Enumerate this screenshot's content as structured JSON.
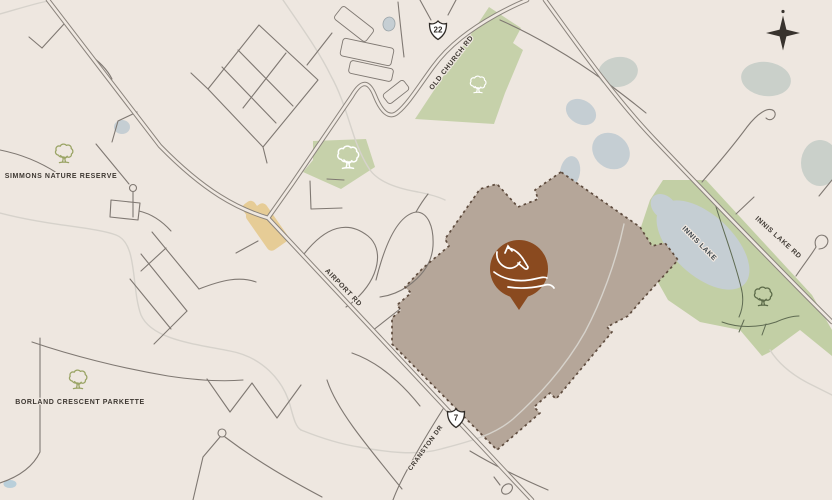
{
  "title": "Site location map",
  "colors": {
    "background": "#eee7e0",
    "road_casing": "#8b847d",
    "road_inner": "#efe8e1",
    "road_minor": "#7f7872",
    "creek": "#d6d2cb",
    "green": "#c6d1aa",
    "water": "#c5ced3",
    "gray_pond": "#cad0ca",
    "property_fill": "#b5a699",
    "property_border": "#5e4b3d",
    "pin": "#8a4a1f",
    "label_text": "#3e3832",
    "lake_label_text": "#3f474c",
    "village": "#e6cc96",
    "compass": "#38332e",
    "tree_olive": "#9aa465",
    "tree_white": "#ffffff",
    "tree_dark": "#5c6b49",
    "trail": "#5f6b52",
    "shield_stroke": "#2e2a26"
  },
  "map": {
    "width": 832,
    "height": 500,
    "labels": [
      {
        "name": "label-simmons-nature-reserve",
        "text": "SIMMONS NATURE RESERVE",
        "x": 61,
        "y": 178,
        "rot": 0,
        "size": 7,
        "color": "#3e3832"
      },
      {
        "name": "label-borland-crescent-parkette",
        "text": "BORLAND CRESCENT PARKETTE",
        "x": 80,
        "y": 404,
        "rot": 0,
        "size": 7,
        "color": "#3e3832"
      },
      {
        "name": "label-old-church-rd",
        "text": "OLD CHURCH RD",
        "x": 453,
        "y": 64,
        "rot": -52,
        "size": 7,
        "color": "#3e3832"
      },
      {
        "name": "label-airport-rd",
        "text": "AIRPORT RD",
        "x": 342,
        "y": 289,
        "rot": 46,
        "size": 7,
        "color": "#3e3832"
      },
      {
        "name": "label-innis-lake-rd",
        "text": "INNIS LAKE RD",
        "x": 777,
        "y": 239,
        "rot": 42,
        "size": 7,
        "color": "#3e3832"
      },
      {
        "name": "label-innis-lake",
        "text": "INNIS LAKE",
        "x": 698,
        "y": 245,
        "rot": 45,
        "size": 7,
        "color": "#3f474c"
      },
      {
        "name": "label-cranston-dr",
        "text": "CRANSTON DR",
        "x": 427,
        "y": 449,
        "rot": -54,
        "size": 6.5,
        "color": "#3e3832"
      }
    ],
    "shields": [
      {
        "name": "highway-22-shield",
        "number": "22",
        "x": 438,
        "y": 30
      },
      {
        "name": "highway-7-shield",
        "number": "7",
        "x": 456,
        "y": 418
      }
    ],
    "shield_path": "M 0,-9 C 2,-6.5 5.5,-5.5 8.5,-6.5 C 8.5,-1 7.5,4.5 0,9.5 C -7.5,4.5 -8.5,-1 -8.5,-6.5 C -5.5,-5.5 -2,-6.5 0,-9 Z",
    "compass": {
      "name": "north-compass",
      "x": 783,
      "y": 33,
      "star": "M 0,-17.5 L 3.4,-3.4 L 17,0 L 3.4,3.4 L 0,17.5 L -3.4,3.4 L -17,0 L -3.4,-3.4 Z",
      "dot_dy": -21.5,
      "dot_r": 1.6
    },
    "greens": [
      {
        "name": "green-old-church-woods",
        "fill": "#c6d1aa",
        "points": [
          [
            489,
            7
          ],
          [
            415,
            119
          ],
          [
            494,
            124
          ],
          [
            505,
            93
          ],
          [
            523,
            50
          ],
          [
            513,
            43
          ],
          [
            521,
            28
          ]
        ]
      },
      {
        "name": "green-airport-parkette",
        "fill": "#c6d1aa",
        "points": [
          [
            313,
            141
          ],
          [
            366,
            139
          ],
          [
            375,
            167
          ],
          [
            341,
            189
          ],
          [
            303,
            172
          ],
          [
            313,
            160
          ]
        ]
      },
      {
        "name": "green-innis-lake-conservation",
        "fill": "#c2cfa5",
        "points": [
          [
            663,
            180
          ],
          [
            706,
            180
          ],
          [
            812,
            295
          ],
          [
            832,
            330
          ],
          [
            832,
            356
          ],
          [
            800,
            330
          ],
          [
            770,
            352
          ],
          [
            762,
            356
          ],
          [
            740,
            330
          ],
          [
            700,
            322
          ],
          [
            668,
            300
          ],
          [
            650,
            268
          ],
          [
            640,
            230
          ],
          [
            650,
            200
          ]
        ]
      }
    ],
    "water": [
      {
        "name": "innis-lake",
        "fill": "#c5ced3",
        "x": 703,
        "y": 245,
        "rx": 57,
        "ry": 30,
        "rot": 43
      },
      {
        "name": "innis-lake-north-lobe",
        "fill": "#c5ced3",
        "x": 664,
        "y": 207,
        "rx": 15,
        "ry": 11,
        "rot": 43
      },
      {
        "name": "pond-small-west",
        "fill": "#c5ced3",
        "x": 122,
        "y": 127,
        "rx": 8,
        "ry": 7,
        "rot": 0
      },
      {
        "name": "pond-outlined",
        "fill": "#c5ced3",
        "stroke": "#9aa4a8",
        "x": 389,
        "y": 24,
        "rx": 6,
        "ry": 7,
        "rot": 10
      },
      {
        "name": "pond-cluster-a",
        "fill": "#c5ced3",
        "x": 581,
        "y": 112,
        "rx": 16,
        "ry": 12,
        "rot": 30
      },
      {
        "name": "pond-cluster-b",
        "fill": "#c5ced3",
        "x": 611,
        "y": 151,
        "rx": 20,
        "ry": 17,
        "rot": 40
      },
      {
        "name": "pond-cluster-c",
        "fill": "#c5ced3",
        "x": 570,
        "y": 172,
        "rx": 10,
        "ry": 16,
        "rot": 10
      },
      {
        "name": "pond-gray-north",
        "fill": "#cad0ca",
        "x": 618,
        "y": 72,
        "rx": 20,
        "ry": 15,
        "rot": -10
      },
      {
        "name": "pond-gray-northeast",
        "fill": "#cad0ca",
        "x": 766,
        "y": 79,
        "rx": 25,
        "ry": 17,
        "rot": 8
      },
      {
        "name": "pond-gray-east-edge",
        "fill": "#cad0ca",
        "x": 820,
        "y": 163,
        "rx": 19,
        "ry": 23,
        "rot": 0
      },
      {
        "name": "pond-bottom-left",
        "fill": "#b9cfda",
        "x": 10,
        "y": 484,
        "rx": 6.5,
        "ry": 4,
        "rot": 0
      }
    ],
    "village_blobs": [
      {
        "name": "village-area-main",
        "x": 267,
        "y": 227,
        "w": 46,
        "h": 24,
        "rot": 55
      },
      {
        "name": "village-area-lobe",
        "x": 252,
        "y": 211,
        "w": 20,
        "h": 14,
        "rot": 55
      }
    ],
    "buildings": [
      {
        "name": "building-outline-1",
        "x": 354,
        "y": 24,
        "w": 40,
        "h": 16,
        "rot": 38
      },
      {
        "name": "building-outline-2",
        "x": 367,
        "y": 52,
        "w": 52,
        "h": 18,
        "rot": 12
      },
      {
        "name": "building-outline-3",
        "x": 371,
        "y": 71,
        "w": 44,
        "h": 13,
        "rot": 12
      },
      {
        "name": "building-outline-4",
        "x": 396,
        "y": 92,
        "w": 26,
        "h": 12,
        "rot": -38
      }
    ],
    "property": {
      "name": "property-parcel",
      "fill": "#b5a699",
      "border": "#5e4b3d",
      "points": [
        [
          561,
          172
        ],
        [
          535,
          190
        ],
        [
          538,
          199
        ],
        [
          518,
          207
        ],
        [
          497,
          184
        ],
        [
          480,
          189
        ],
        [
          445,
          239
        ],
        [
          449,
          246
        ],
        [
          423,
          268
        ],
        [
          405,
          287
        ],
        [
          411,
          293
        ],
        [
          397,
          305
        ],
        [
          401,
          310
        ],
        [
          392,
          318
        ],
        [
          392,
          344
        ],
        [
          497,
          450
        ],
        [
          540,
          413
        ],
        [
          534,
          407
        ],
        [
          550,
          393
        ],
        [
          556,
          399
        ],
        [
          612,
          332
        ],
        [
          607,
          327
        ],
        [
          628,
          316
        ],
        [
          640,
          302
        ],
        [
          678,
          260
        ],
        [
          665,
          243
        ],
        [
          652,
          246
        ],
        [
          640,
          227
        ]
      ]
    },
    "creeks": [
      {
        "name": "creek-top-left",
        "d": "M 0,14 C 18,9 33,4 48,1"
      },
      {
        "name": "creek-west",
        "d": "M 0,213 C 50,226 95,227 116,235 C 138,243 131,288 141,315 C 152,340 196,344 230,351 C 262,357 283,380 290,405 C 294,420 296,427 301,430"
      },
      {
        "name": "creek-old-church",
        "d": "M 283,0 C 300,25 319,51 331,76 C 341,94 346,112 352,130 C 357,146 362,158 370,170 C 378,181 394,188 418,192 C 428,194 437,196 445,200"
      },
      {
        "name": "creek-property",
        "d": "M 624,224 C 616,262 601,302 585,332 C 567,364 541,394 513,419 C 493,436 467,442 441,449 C 416,456 386,452 359,447 C 339,444 316,436 301,430"
      },
      {
        "name": "creek-lake-outlet",
        "d": "M 770,350 C 780,366 797,378 814,386 C 820,389 826,392 832,395"
      }
    ],
    "roads_minor": [
      {
        "name": "street",
        "d": "M 64,24 L 42,48"
      },
      {
        "name": "street",
        "d": "M 42,48 L 29,37"
      },
      {
        "name": "street",
        "d": "M 87,53 C 99,61 107,69 112,79"
      },
      {
        "name": "street-subdivision-loop",
        "d": "M 259,25 L 318,80 L 263,147 L 208,89 Z"
      },
      {
        "name": "street",
        "d": "M 238,50 L 293,106"
      },
      {
        "name": "street",
        "d": "M 222,67 L 276,123"
      },
      {
        "name": "street",
        "d": "M 286,53 L 243,108"
      },
      {
        "name": "street",
        "d": "M 208,89 L 191,73"
      },
      {
        "name": "street",
        "d": "M 263,147 L 267,163"
      },
      {
        "name": "street",
        "d": "M 420,0 L 431,20"
      },
      {
        "name": "street",
        "d": "M 456,0 L 448,15"
      },
      {
        "name": "street",
        "d": "M 332,33 L 307,65"
      },
      {
        "name": "street",
        "d": "M 398,2 C 400,22 402,40 404,57"
      },
      {
        "name": "street",
        "d": "M 112,142 L 118,121 L 137,112"
      },
      {
        "name": "street",
        "d": "M 133,192 L 133,217"
      },
      {
        "name": "street-block-loop",
        "d": "M 111,200 L 140,203 L 138,220 L 110,217 Z"
      },
      {
        "name": "street",
        "d": "M 139,211 C 152,214 162,221 171,231"
      },
      {
        "name": "street",
        "d": "M 96,144 L 129,184"
      },
      {
        "name": "street",
        "d": "M 0,150 C 20,154 40,162 57,173"
      },
      {
        "name": "street",
        "d": "M 152,232 L 199,289"
      },
      {
        "name": "street",
        "d": "M 141,254 L 187,311"
      },
      {
        "name": "street",
        "d": "M 130,279 L 171,329"
      },
      {
        "name": "street",
        "d": "M 166,248 L 141,271"
      },
      {
        "name": "street",
        "d": "M 187,311 L 154,344"
      },
      {
        "name": "street",
        "d": "M 199,289 C 222,280 240,276 256,282"
      },
      {
        "name": "street",
        "d": "M 236,253 L 258,241"
      },
      {
        "name": "street",
        "d": "M 310,181 L 311,209 L 342,208"
      },
      {
        "name": "street",
        "d": "M 327,179 L 344,180"
      },
      {
        "name": "street-arch",
        "d": "M 304,254 C 326,226 348,220 368,236 C 384,249 380,277 355,300 C 352,303 349,305 346,307"
      },
      {
        "name": "street-arch",
        "d": "M 376,280 C 386,240 399,215 416,212 C 428,212 434,227 433,246 C 432,263 422,276 408,286 C 398,293 388,296 380,297"
      },
      {
        "name": "street",
        "d": "M 416,212 C 420,205 424,199 428,194"
      },
      {
        "name": "street",
        "d": "M 372,331 L 400,309"
      },
      {
        "name": "street",
        "d": "M 352,353 C 378,362 400,381 420,406"
      },
      {
        "name": "street-cranston-dr",
        "d": "M 443,409 C 431,428 420,446 411,463 C 403,477 397,489 393,500"
      },
      {
        "name": "street",
        "d": "M 40,338 L 40,452 C 33,467 18,477 0,483"
      },
      {
        "name": "street",
        "d": "M 32,342 C 70,355 120,368 168,376 C 195,380 220,382 243,380"
      },
      {
        "name": "street",
        "d": "M 207,379 L 230,412 L 252,383 L 277,418 L 301,385"
      },
      {
        "name": "street",
        "d": "M 327,380 C 336,408 362,440 402,489"
      },
      {
        "name": "street",
        "d": "M 220,437 L 203,457 L 193,500"
      },
      {
        "name": "street",
        "d": "M 225,437 C 258,462 290,480 322,497"
      },
      {
        "name": "street",
        "d": "M 500,485 L 494,477"
      },
      {
        "name": "street",
        "d": "M 470,451 C 495,466 520,478 548,490"
      },
      {
        "name": "street",
        "d": "M 500,20 C 532,34 572,57 606,82 C 622,94 634,103 646,113"
      },
      {
        "name": "street",
        "d": "M 736,214 L 754,197"
      },
      {
        "name": "street-hook-north",
        "d": "M 702,182 C 712,170 727,154 747,127 C 757,114 768,106 774,111 C 778,116 771,123 766,118"
      },
      {
        "name": "street-hook-east",
        "d": "M 796,276 C 804,264 812,254 816,247 C 813,239 819,233 825,236 C 831,240 827,249 819,249"
      },
      {
        "name": "street",
        "d": "M 832,180 L 819,196"
      }
    ],
    "trails": [
      {
        "name": "park-trail",
        "d": "M 714,200 C 722,228 734,258 741,287 C 744,298 743,308 739,317"
      },
      {
        "name": "park-trail",
        "d": "M 722,322 C 738,328 758,328 776,322 C 785,318 792,316 799,316"
      },
      {
        "name": "park-trail",
        "d": "M 744,320 L 739,332"
      },
      {
        "name": "park-trail",
        "d": "M 766,324 L 762,335"
      }
    ],
    "roads_major": [
      {
        "name": "road-airport-rd-hwy7",
        "d": "M 48,0 L 160,146 C 205,192 238,209 268,218 L 532,500"
      },
      {
        "name": "road-old-church-rd",
        "d": "M 268,218 L 292,184 L 352,96 C 362,79 369,81 375,96 C 381,111 389,120 398,112 C 408,104 419,86 433,67 C 449,45 471,29 496,15 C 507,9 517,4 527,0"
      },
      {
        "name": "road-innis-lake-rd",
        "d": "M 545,0 C 577,44 613,96 655,140 C 716,204 776,266 832,322"
      }
    ],
    "culdesacs": [
      {
        "name": "cul-de-sac",
        "x": 133,
        "y": 188,
        "r": 3.5
      },
      {
        "name": "cul-de-sac",
        "x": 222,
        "y": 433,
        "r": 4
      },
      {
        "name": "street-oval-loop",
        "x": 507,
        "y": 489,
        "rx": 6,
        "ry": 4.5,
        "rot": -40
      }
    ],
    "trees": [
      {
        "name": "tree-icon-simmons",
        "x": 64,
        "y": 154,
        "s": 1.0,
        "color": "#9aa465"
      },
      {
        "name": "tree-icon-borland",
        "x": 78,
        "y": 380,
        "s": 1.0,
        "color": "#9aa465"
      },
      {
        "name": "tree-icon-old-church-green",
        "x": 478,
        "y": 85,
        "s": 0.9,
        "color": "#ffffff"
      },
      {
        "name": "tree-icon-parkette-green",
        "x": 348,
        "y": 158,
        "s": 1.2,
        "color": "#ffffff"
      },
      {
        "name": "tree-icon-innis-green",
        "x": 763,
        "y": 297,
        "s": 1.0,
        "color": "#5c6b49"
      }
    ],
    "tree_glyph": {
      "canopy": "M 6.5,13.2 C 3.8,12.8 2.6,10.2 4.2,8.2 C 3.2,5.6 5.6,3.2 8.2,4.2 C 9.2,1.8 12.8,1.4 14.4,3.4 C 16.8,2.2 19.6,4 19.2,6.6 C 21.4,7.8 21.4,10.8 19.4,12 C 19.8,14.4 17.2,16 15.2,14.8 C 13.8,16.2 11.4,16.2 10,14.8 C 8.6,15.4 7.2,14.6 6.5,13.2 Z",
      "trunk": "M 11.2,14.8 C 11.3,16.6 11,18.4 10.4,20.2 M 12.8,15 C 12.8,16.8 13,18.6 13.6,20.2 M 11.3,16.4 L 8.6,13.6 M 12.7,16.8 L 15.2,14.2 M 7.4,20.6 C 9.4,19.9 14.6,19.9 16.6,20.6"
    },
    "pin": {
      "name": "property-pin-horse",
      "x": 519,
      "y": 269,
      "r": 29,
      "tip": [
        [
          507,
          292
        ],
        [
          531,
          292
        ],
        [
          519,
          310
        ]
      ],
      "color": "#8a4a1f",
      "horse_icon_paths": [
        "M 505,253 L 508,246 L 512,251",
        "M 508,248 C 515,249 521,255 525,262 L 528,267 C 528,269 526,270 524,268 L 518,263",
        "M 520,262 C 517,267 511,270 505,267 C 499,264 496,258 497,252",
        "M 494,272 C 503,279 516,282 529,280 C 537,279 543,276 547,278",
        "M 508,287 C 520,289 534,288 545,285 C 549,284 552,285 554,288"
      ]
    }
  }
}
